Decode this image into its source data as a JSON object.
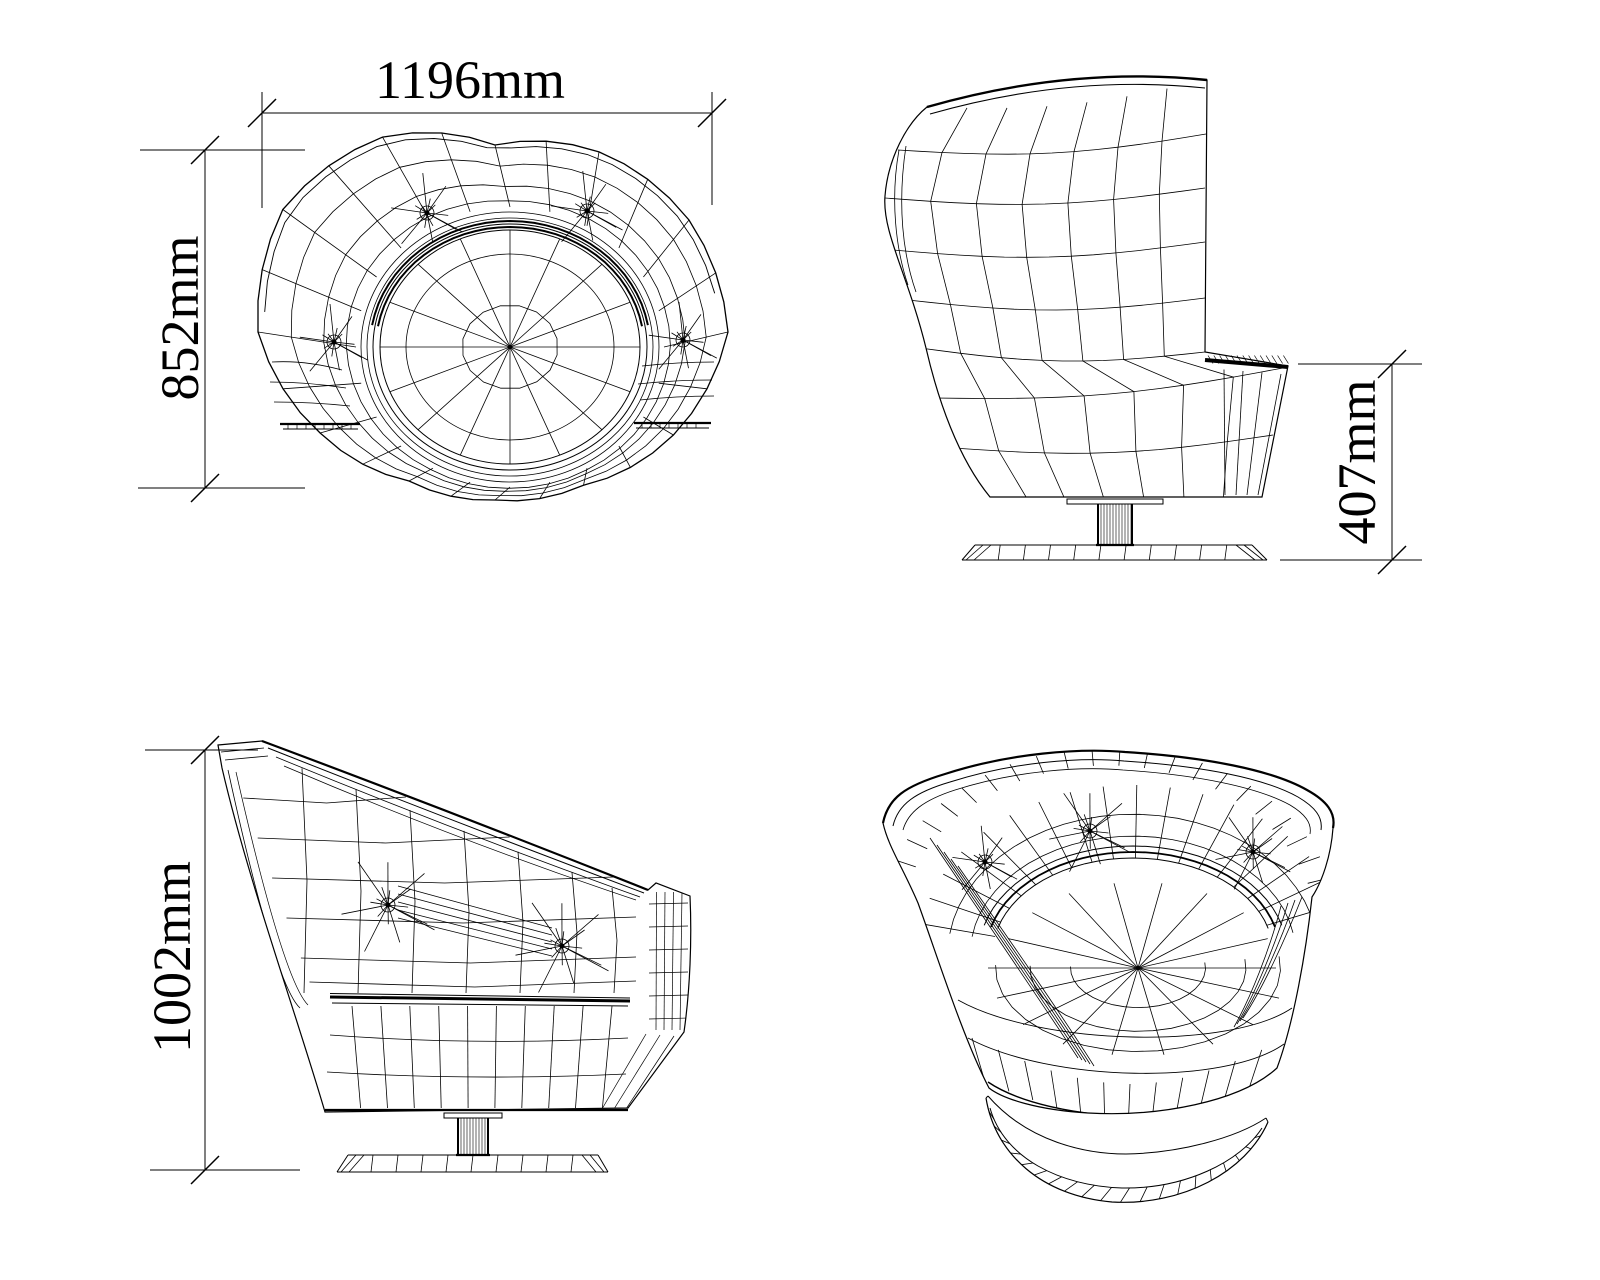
{
  "page": {
    "background_color": "#ffffff",
    "line_color": "#000000"
  },
  "drawing": {
    "type": "four-view wireframe technical drawing of a swivel tub chair"
  },
  "dimensions": {
    "plan_width": {
      "label": "1196mm"
    },
    "plan_depth": {
      "label": "852mm"
    },
    "seat_height": {
      "label": "407mm"
    },
    "total_height": {
      "label": "1002mm"
    }
  }
}
